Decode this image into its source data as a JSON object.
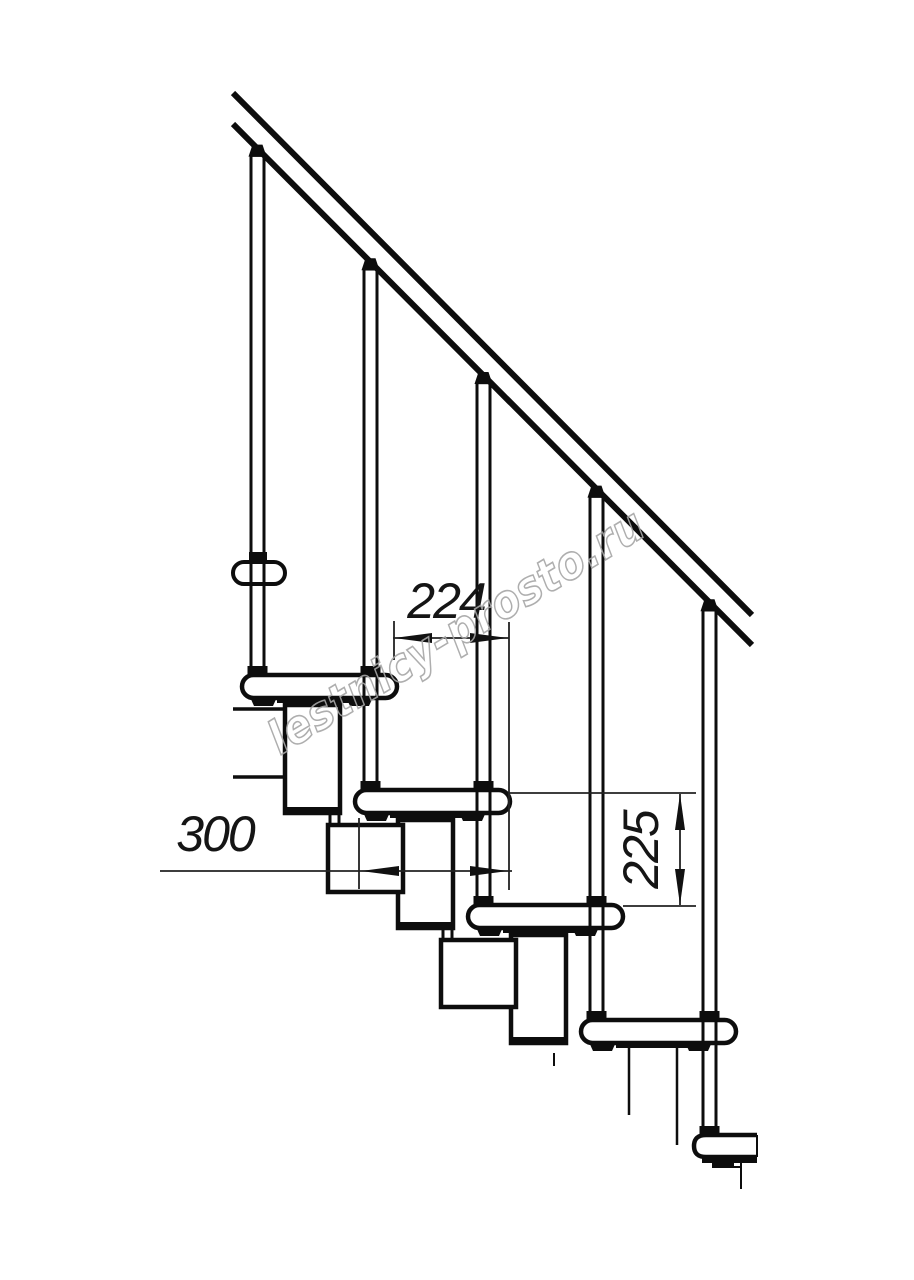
{
  "watermark": {
    "text": "lestnicy-prosto.ru",
    "color": "#a6a6a6"
  },
  "dimensions": {
    "going": {
      "label": "224"
    },
    "depth": {
      "label": "300"
    },
    "rise": {
      "label": "225"
    }
  },
  "drawing": {
    "type": "staircase-side-view-technical-drawing",
    "steps_visible": 5,
    "balusters_visible": 5,
    "line_color": "#0d0d0d",
    "background": "#ffffff"
  }
}
